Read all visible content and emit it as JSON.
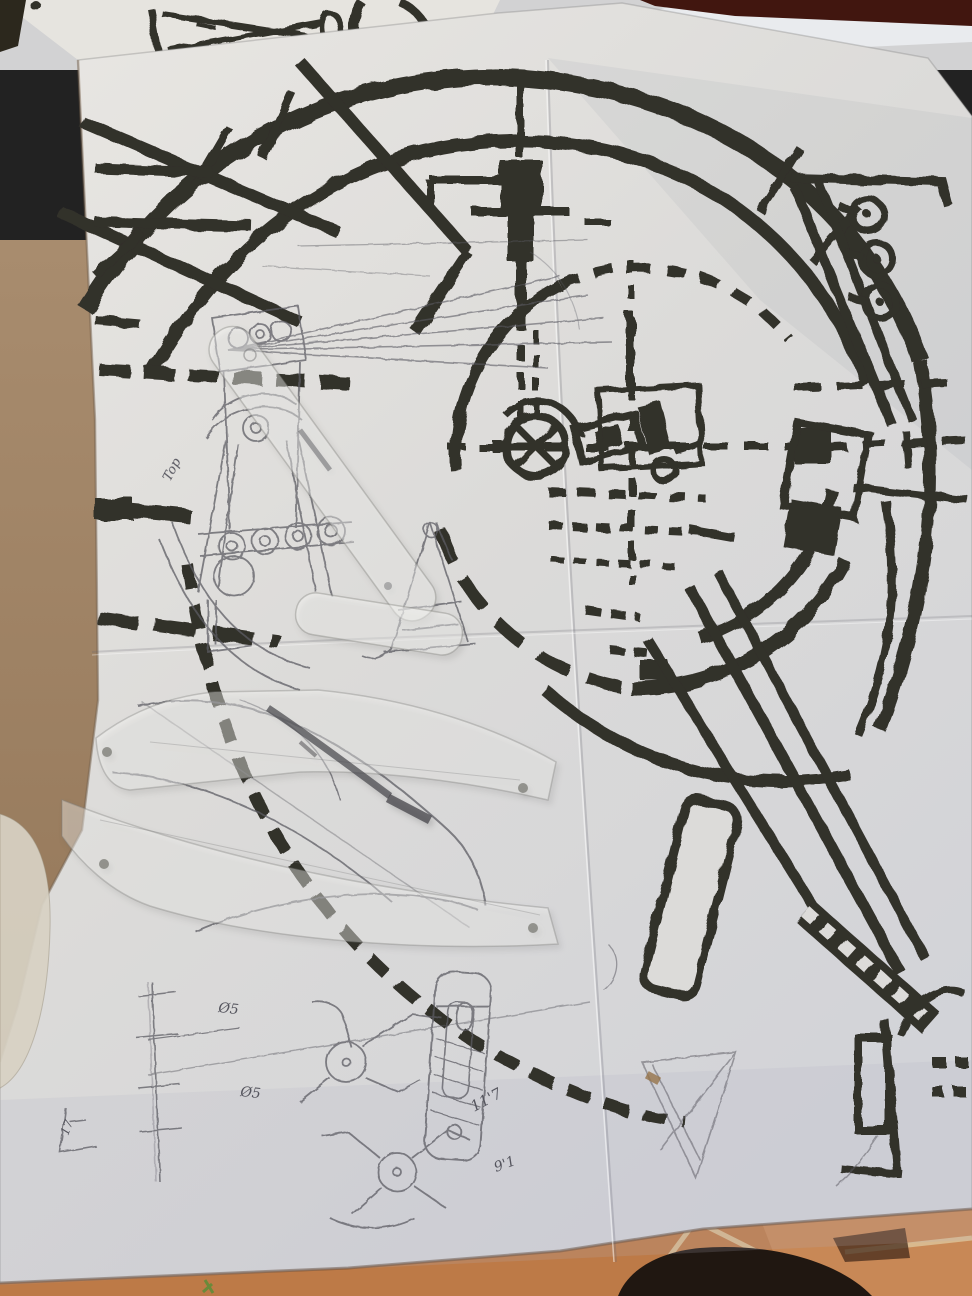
{
  "scene": {
    "type": "photograph",
    "description": "Folded photocopied machine blueprint with heavy black arcs, dashed centerlines and a spoked hub, overlaid with pencil sketches and two translucent acrylic templates, lying on a wooden table; terracotta tile floor and a dark foot shadow visible at the bottom edge, another printed sheet behind at top.",
    "handwriting": {
      "top_label": "Top",
      "dimension_1": "11'7",
      "dimension_2": "9'1",
      "diameter_1": "Ø5",
      "diameter_2": "Ø5",
      "corner_mark": "17"
    },
    "colors": {
      "print_ink": "#33302b",
      "pencil": "#5c5b63",
      "paper": "#dcdbd9",
      "paper_shade": "#c7c9d1",
      "wood_table": "#a28364",
      "tile_floor": "#bd7a47",
      "tile_grout": "#dcc298",
      "top_band": "#41160f",
      "foot_shadow": "#201711",
      "background_sheet": "#d2d2d3",
      "plastic_template": "rgba(250,250,247,0.42)"
    }
  }
}
